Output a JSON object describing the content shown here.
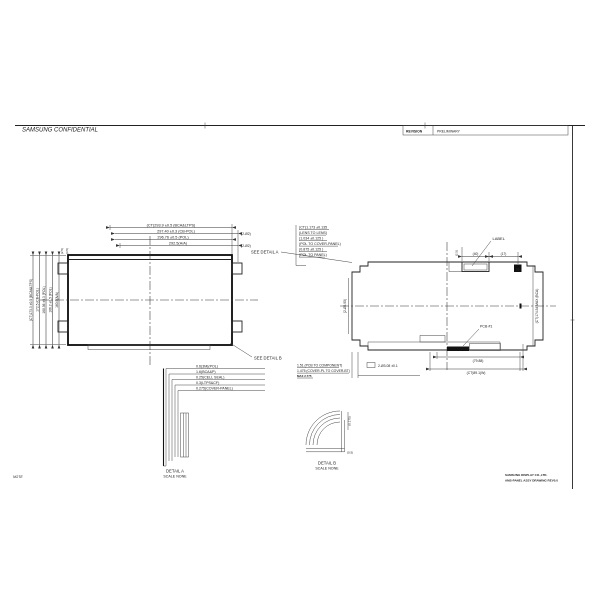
{
  "frame": {
    "confidential": "SAMSUNG CONFIDENTIAL",
    "note": "NOTE",
    "revision_label": "REVISION",
    "revision_value": "PRELIMINARY",
    "doc_line1": "SAMSUNG DISPLAY CO.,LTD.",
    "doc_line2": "AMS-PANEL ASSY DRAWING REV0.0"
  },
  "front_view": {
    "top_dims": [
      "(CT)293.9 ±0.5 (BCA&LTPS)",
      "297.40 ±0.3 (CB-POL)",
      "296.76 ±0.5 (POL)",
      "292.5(A/A)"
    ],
    "top_dim_tails": [
      "(2-Ø2)",
      "(2-Ø2)"
    ],
    "left_dims": [
      "(CT)173.3 ±0.5 (BCA&LTPS)",
      "172.5 (CB-POL)",
      "168.56 ±0.3 (POL)",
      "166.2 ±0.5 (POL)",
      "160.9(A/A)"
    ],
    "corner_dims": [
      "(2.5)",
      "(3.5)"
    ],
    "see_detail_b": "SEE DETAIL B"
  },
  "thickness_callout": {
    "see_detail_a": "SEE DETAIL A",
    "lines": [
      "(CT)1.173 ±0.135",
      "(LENS TO LENS)",
      "(1.034 ±0.125 )",
      "(POL TO COVER-PANEL)",
      "(0.875 ±0.125 )",
      "(POL TO PANEL)"
    ]
  },
  "rear_view": {
    "label": "LABEL",
    "dim_40": "(40)",
    "dim_17": "(17)",
    "dim_2_5": "(2.5)",
    "mark": "H",
    "height_dim": "(CT)174.54 MAX (BCA)",
    "left_dim": "(2-Ø3.05)",
    "pcb": "PCB #1",
    "width_dim_1": "(79.88)",
    "width_dim_2": "(CT)89.1(W)",
    "hole_dim": "2-Ø3.08 ±0.1",
    "notes": [
      "1.51 (PCB TO COMPONENT)",
      "1.475 (COVER-PL TO COVER-BT)",
      "MAX 2.775"
    ]
  },
  "detail_a": {
    "title": "DETAIL A",
    "scale": "SCALE NONE",
    "layers": [
      "0.6(3M)(POL)",
      "1.6(BCA&P)",
      "0.25(CELL SEAL)",
      "0.3(LTPS&CF)",
      "0.275(COVER-PANEL)"
    ]
  },
  "detail_b": {
    "title": "DETAIL B",
    "scale": "SCALE NONE",
    "dim_thickness": "(0.175)",
    "dim_radius": "(0.5)"
  }
}
